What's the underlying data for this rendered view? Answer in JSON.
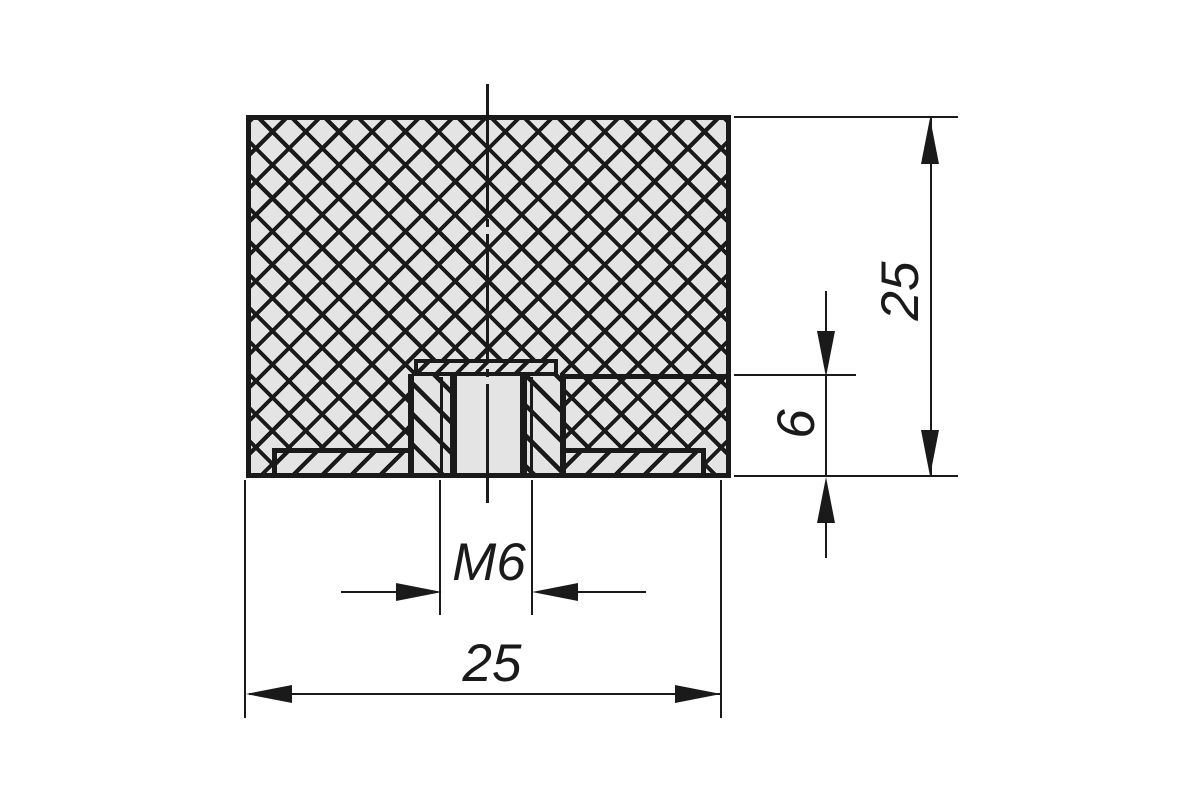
{
  "sheet": {
    "dimensions": {
      "overall_height": "25",
      "overall_diameter": "25",
      "insert_depth": "6",
      "thread_size": "M6"
    },
    "colors": {
      "line": "#1a1a1a",
      "section_fill": "#e4e4e4",
      "background": "#ffffff"
    }
  }
}
